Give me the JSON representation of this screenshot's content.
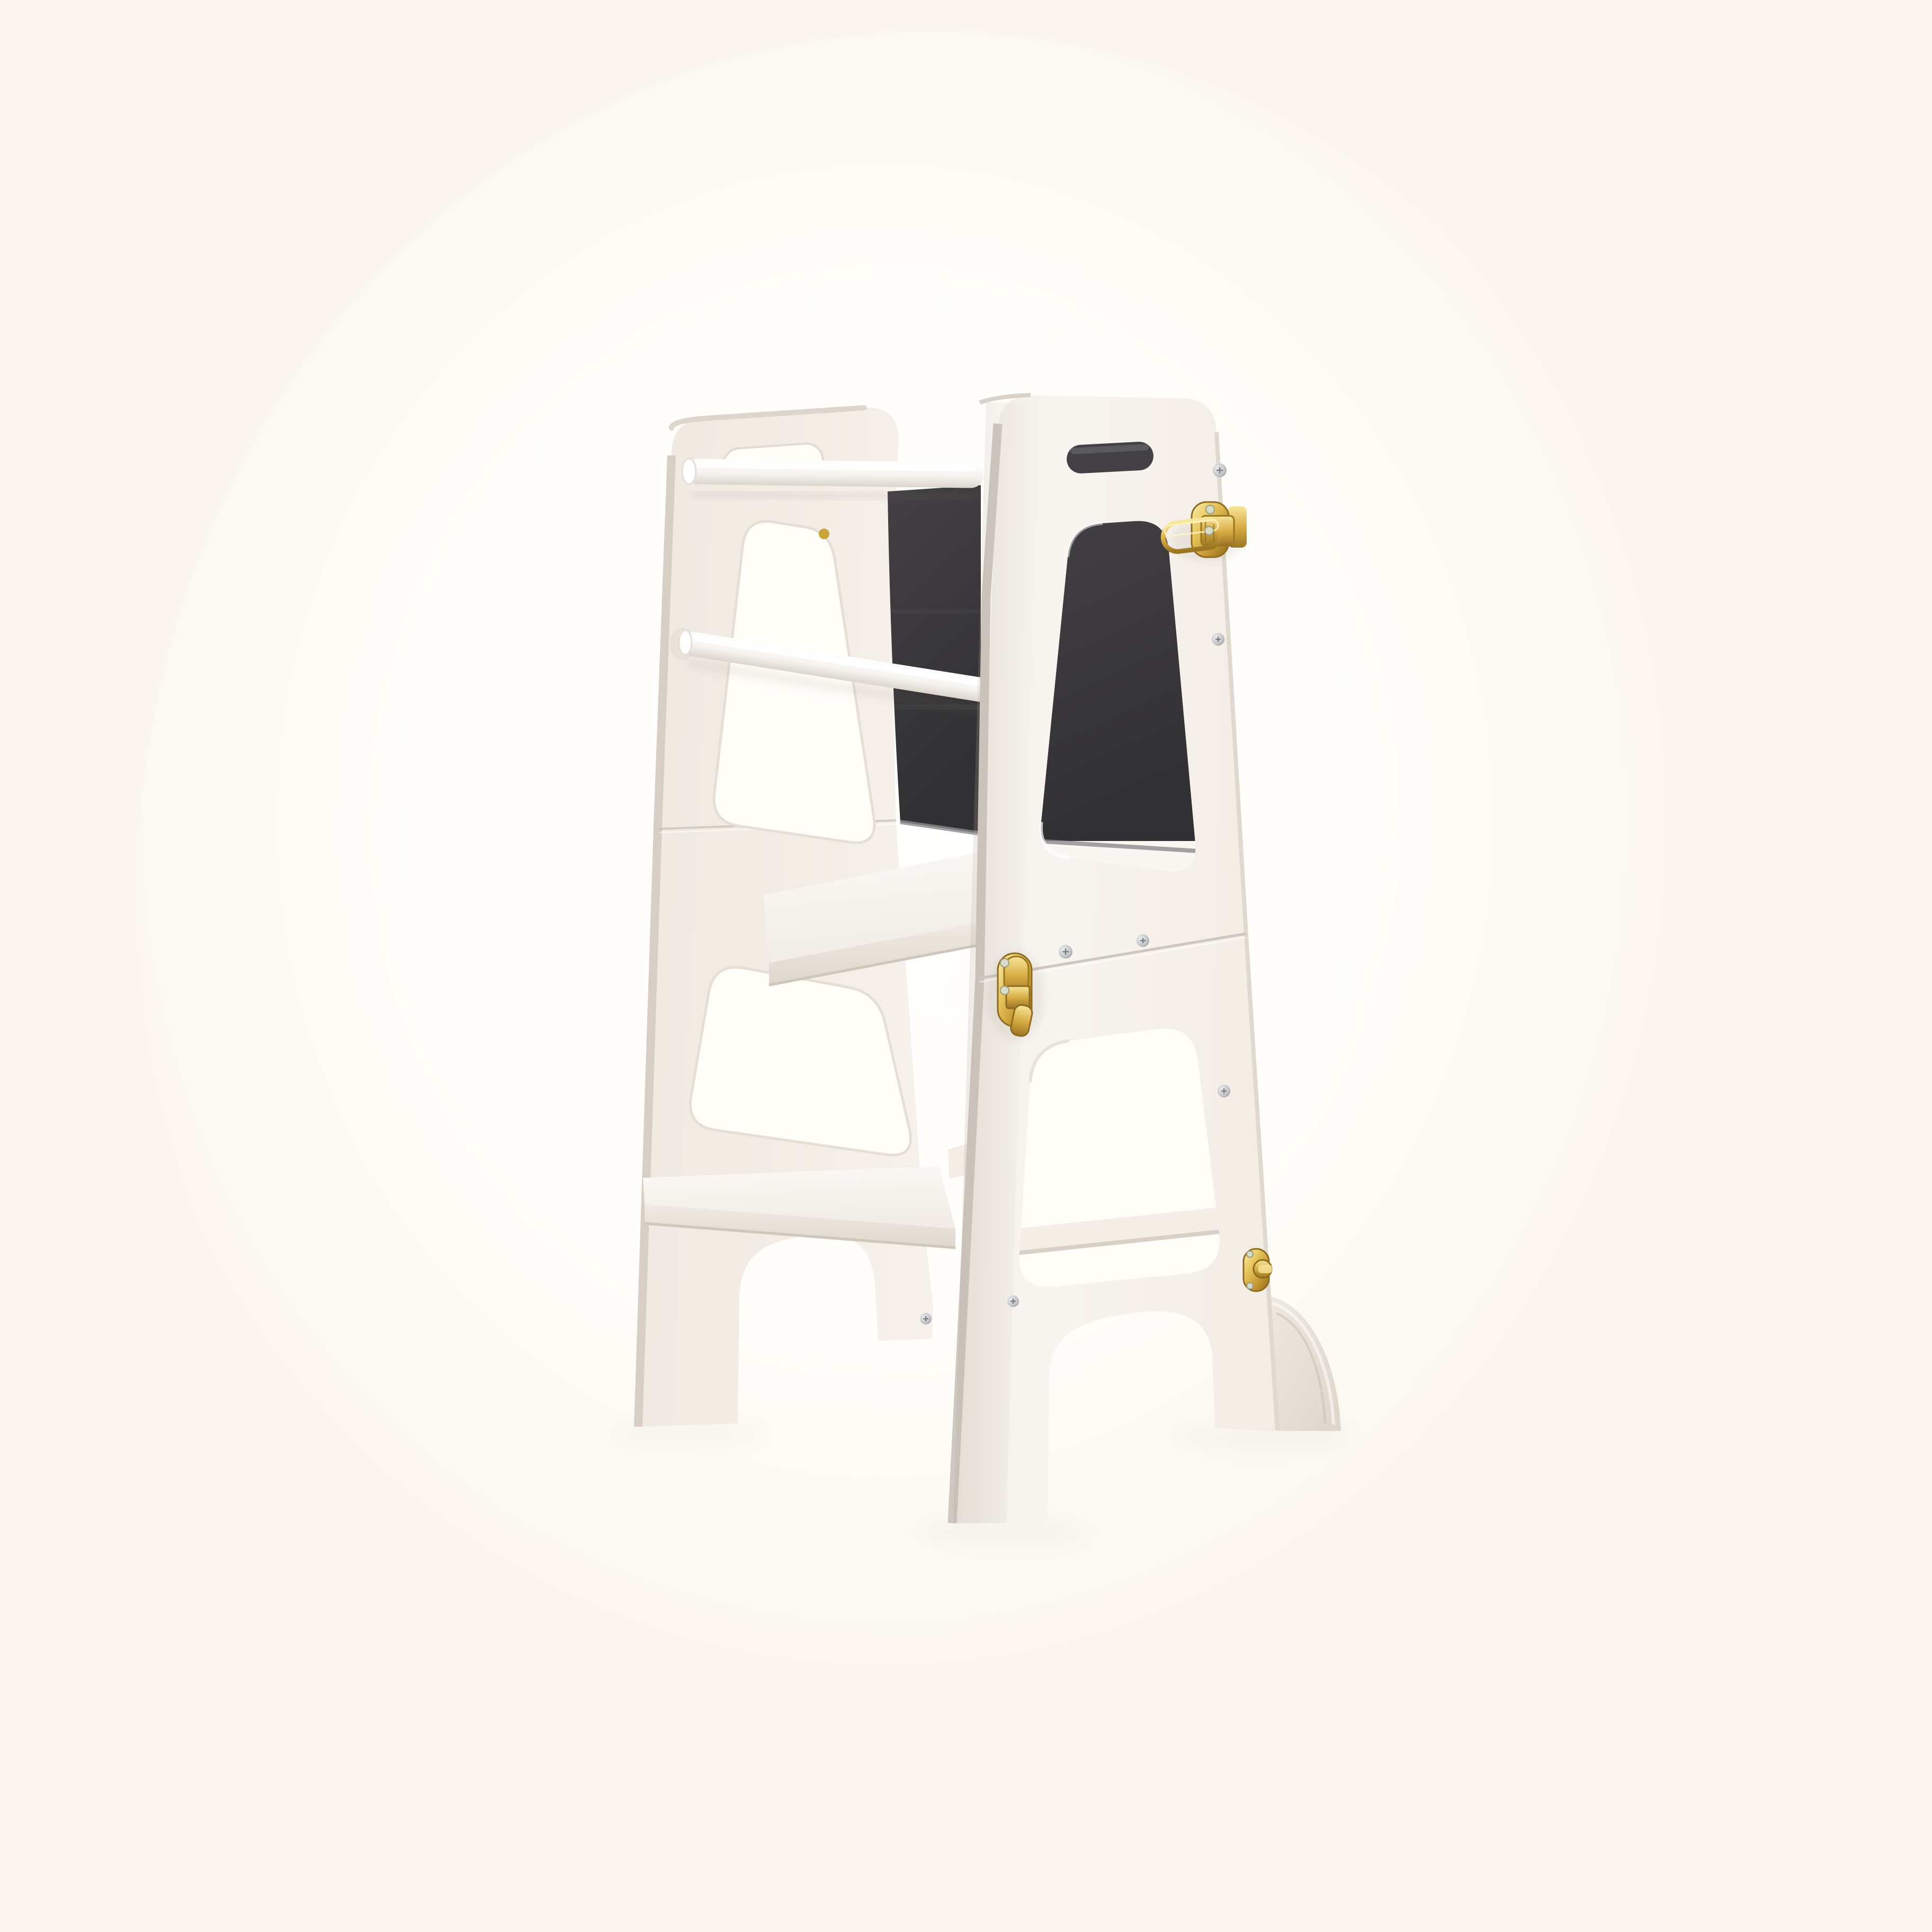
{
  "meta": {
    "content_type": "product-photo",
    "subject": "foldable white learning tower step stool with chalkboard back panel and brass hardware",
    "visible_text_count": 0
  },
  "colors": {
    "background": "#FBF6EF",
    "background_glow": "#FFFEFB",
    "cutout_light": "#FFFDF8",
    "panel_white": "#F2ECE5",
    "panel_white_bright": "#F8F4EF",
    "panel_edge": "#D6CEC5",
    "rail_white": "#FDFCFA",
    "step_white": "#FAF7F2",
    "chalkboard": "#3A383B",
    "chalkboard_light": "#4A484C",
    "slot_dark": "#434145",
    "brass": "#D9AE45",
    "brass_light": "#F9E9A6",
    "brass_dark": "#8E6B1E",
    "screw_silver": "#C4C7C9",
    "screw_gold": "#C9A43B",
    "shadow": "#8A7A66"
  },
  "product": {
    "panel_finish": "matte white",
    "hardware_finish": "polished brass",
    "rail_count": 2,
    "step_count": 2,
    "handle_slots_per_panel": 1,
    "window_cutouts_per_panel": 2,
    "visible_silver_screw_count": 7,
    "visible_gold_screw_count": 1,
    "parts": [
      "left side panel",
      "right side panel",
      "chalkboard back panel",
      "top handrail",
      "middle handrail",
      "standing platform",
      "bottom step",
      "rear stretcher bar",
      "quarter-round support foot"
    ],
    "hardware": [
      "toggle latch with wire loop",
      "fold box latch",
      "turn latch knob"
    ]
  }
}
